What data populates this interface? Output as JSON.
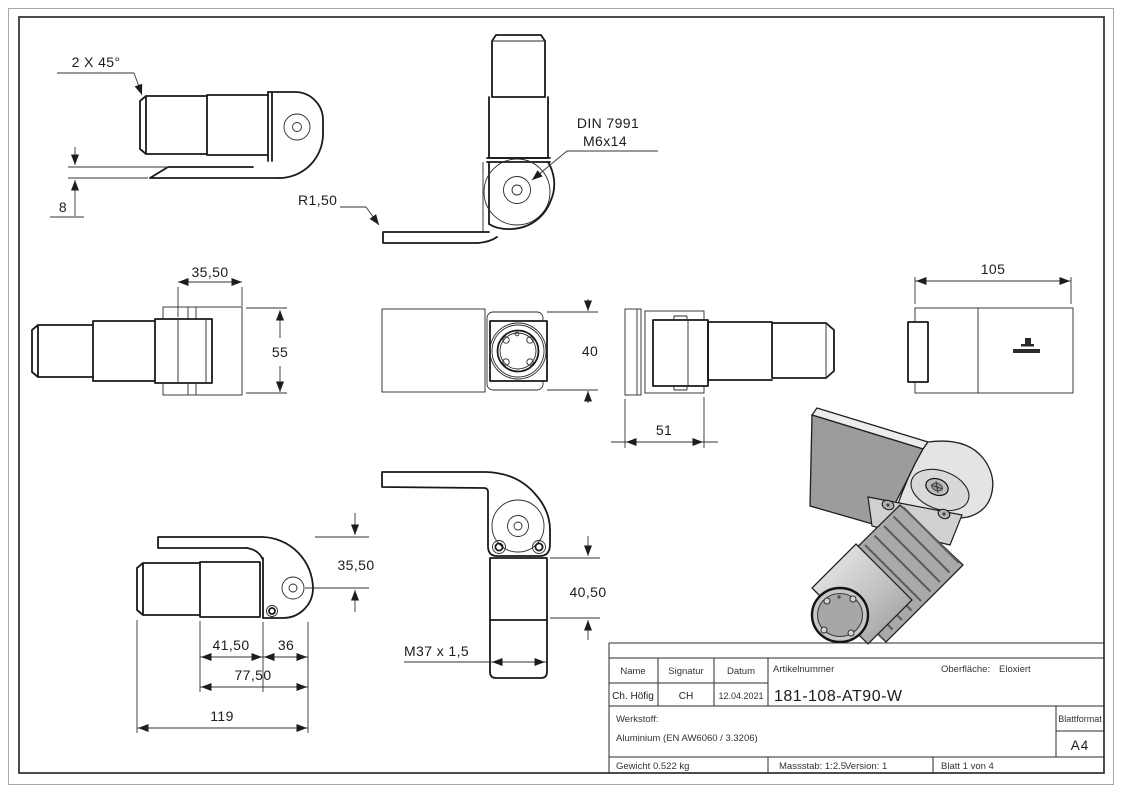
{
  "dimensions": {
    "chamfer": "2 X 45°",
    "plate_thickness": "8",
    "screw_spec_line1": "DIN 7991",
    "screw_spec_line2": "M6x14",
    "fillet_radius": "R1,50",
    "hinge_width": "35,50",
    "body_height": "55",
    "body_width": "40",
    "body_depth": "51",
    "back_length": "105",
    "hole_offset": "35,50",
    "seg_41_5": "41,50",
    "seg_36": "36",
    "seg_77_5": "77,50",
    "overall_length": "119",
    "thread_spec": "M37 x 1,5",
    "front_height": "40,50"
  },
  "title_block": {
    "name_label": "Name",
    "signature_label": "Signatur",
    "date_label": "Datum",
    "name_value": "Ch. Höfig",
    "signature_value": "CH",
    "date_value": "12.04.2021",
    "article_label": "Artikelnummer",
    "article_number": "181-108-AT90-W",
    "surface_label": "Oberfläche:",
    "surface_value": "Eloxiert",
    "material_label": "Werkstoff:",
    "material_value": "Aluminium (EN AW6060 / 3.3206)",
    "weight": "Gewicht 0.522 kg",
    "scale": "Massstab: 1:2.5",
    "version": "Version: 1",
    "sheet_number": "Blatt 1 von 4",
    "format_label": "Blattformat",
    "format_value": "A4"
  },
  "colors": {
    "line": "#1c1c1c",
    "plate_face": "#9c9c9c",
    "metal_light": "#e4e4e4",
    "metal_mid": "#c9c9c9",
    "thread_dark": "#a9a9a9"
  }
}
